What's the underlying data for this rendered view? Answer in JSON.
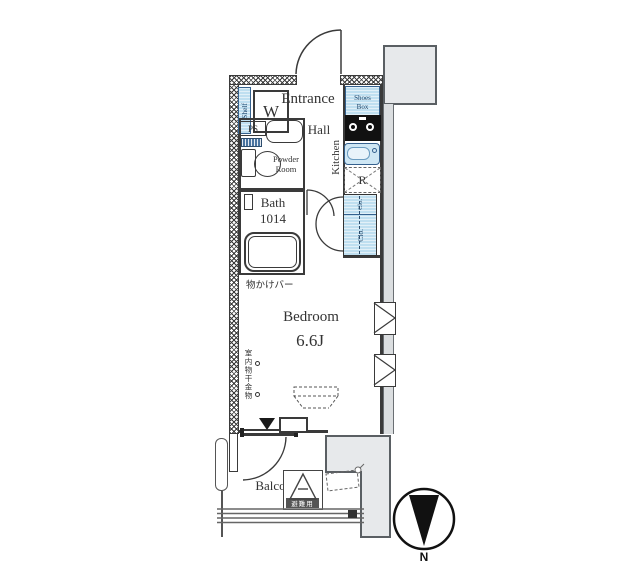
{
  "rooms": {
    "entrance": "Entrance",
    "hall": "Hall",
    "kitchen": "Kitchen",
    "powder_room": "Powder Room",
    "bath": "Bath",
    "bath_size": "1014",
    "bedroom": "Bedroom",
    "bedroom_size": "6.6J",
    "balcony": "Balcony"
  },
  "fixtures": {
    "washing_machine": "W",
    "shelf": "Shelf",
    "pipe_space": "PS",
    "shoes_box": "Shoes Box",
    "refrigerator": "R",
    "closet_upper": "Clo.",
    "closet_lower": "Clo.",
    "evacuation_hatch": "避難用"
  },
  "annotations": {
    "hanging_bar": "物かけバー",
    "indoor_laundry": "室内物干金物"
  },
  "compass": {
    "north": "N"
  },
  "colors": {
    "wall": "#3a3a3a",
    "fixture_blue": "#bfdff0",
    "fixture_blue_border": "#35618e",
    "structure_gray": "#e7e9eb"
  }
}
